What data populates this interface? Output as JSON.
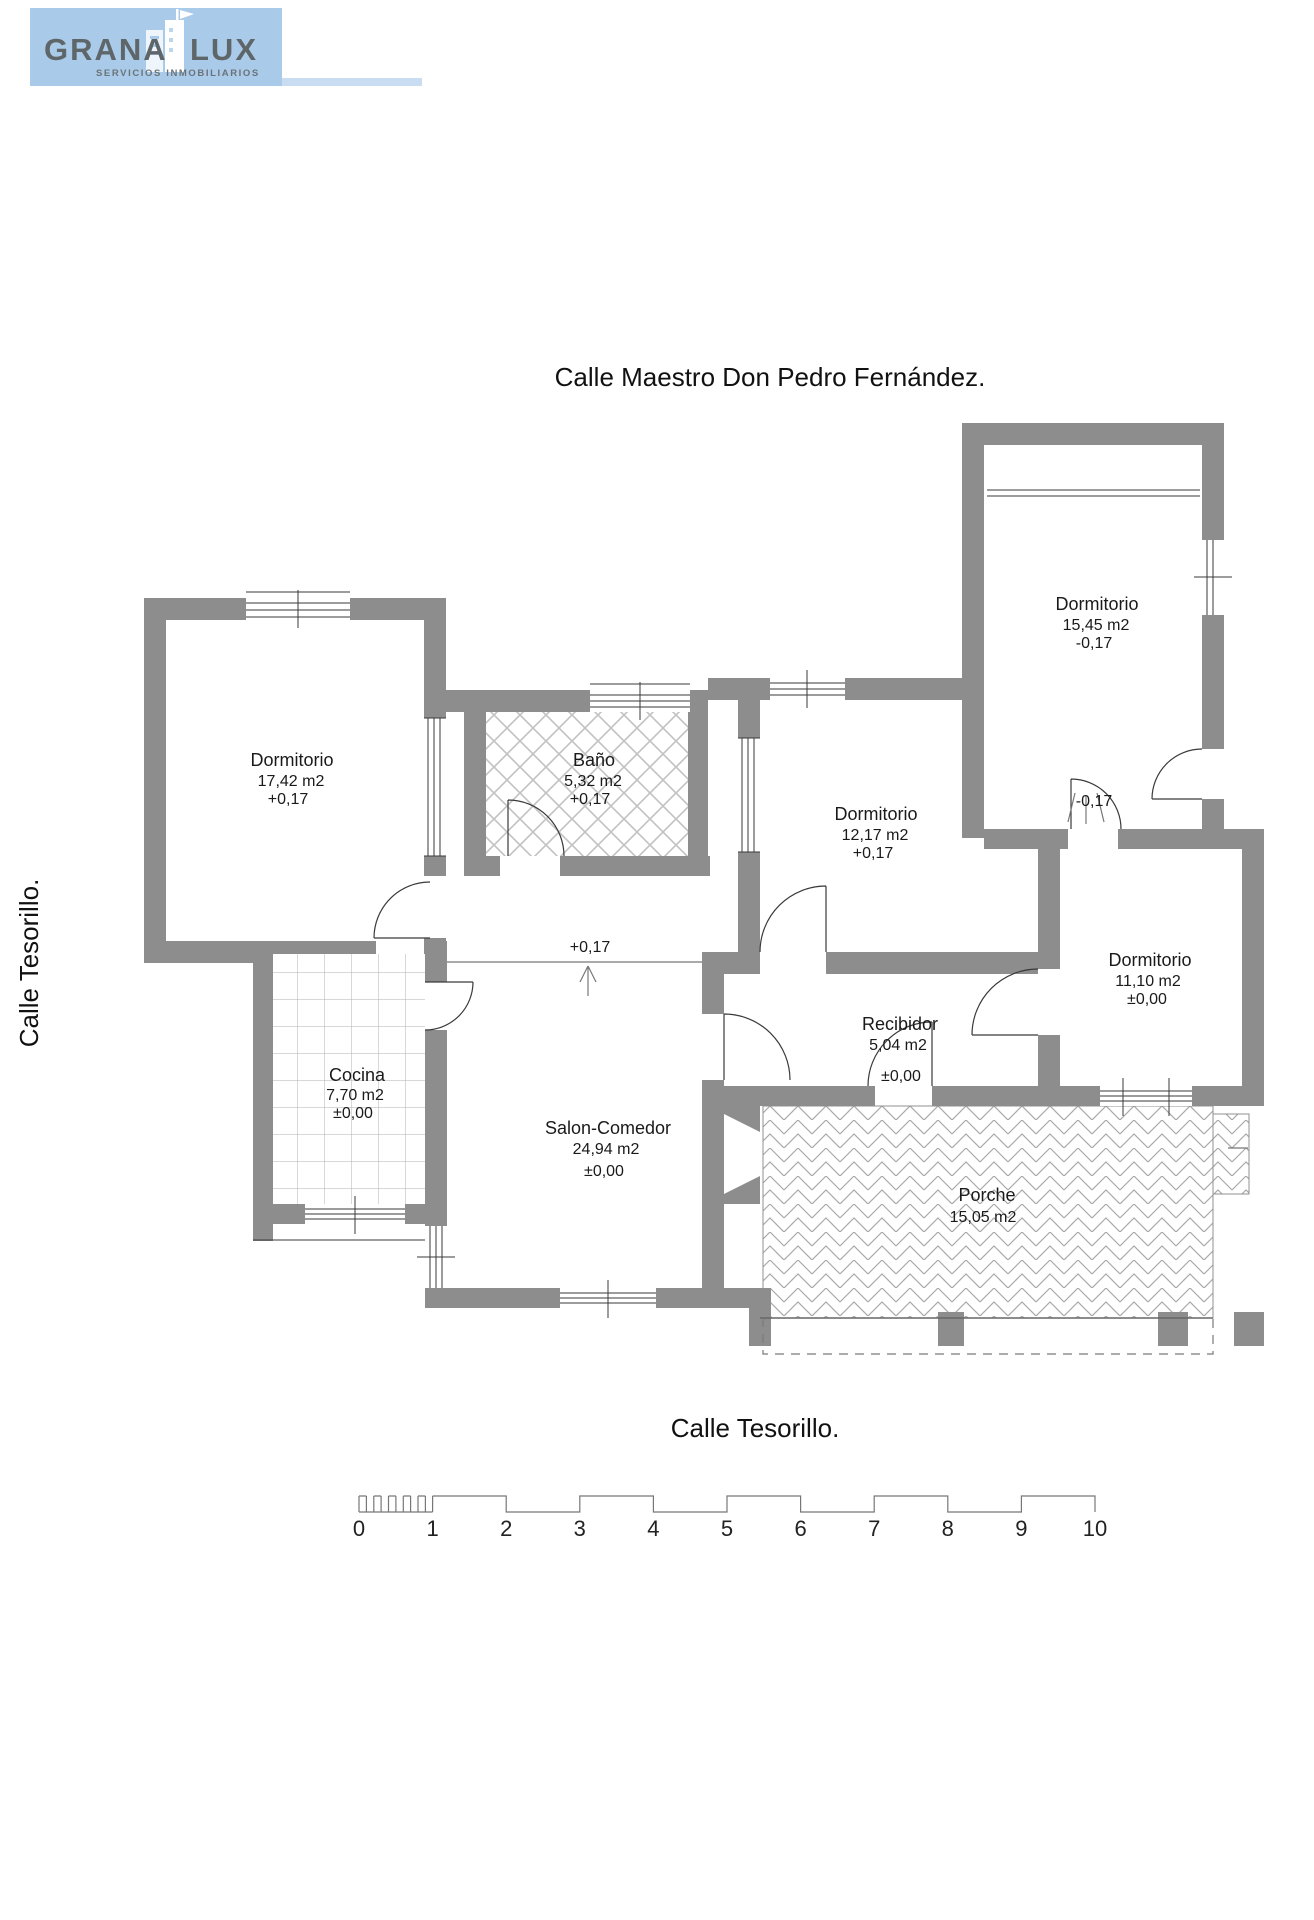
{
  "logo": {
    "brand_left": "GRANA",
    "brand_right": "LUX",
    "tagline": "SERVICIOS INMOBILIARIOS"
  },
  "streets": {
    "top": "Calle  Maestro Don Pedro Fernández.",
    "left": "Calle  Tesorillo.",
    "bottom": "Calle  Tesorillo."
  },
  "rooms": {
    "dormitorio_1742": {
      "name": "Dormitorio",
      "area": "17,42 m2",
      "level": "+0,17"
    },
    "bano": {
      "name": "Baño",
      "area": "5,32 m2",
      "level": "+0,17"
    },
    "dormitorio_1217": {
      "name": "Dormitorio",
      "area": "12,17 m2",
      "level": "+0,17"
    },
    "dormitorio_1545": {
      "name": "Dormitorio",
      "area": "15,45 m2",
      "level": "-0,17"
    },
    "dormitorio_1110": {
      "name": "Dormitorio",
      "area": "11,10 m2",
      "level": "±0,00"
    },
    "cocina": {
      "name": "Cocina",
      "area": "7,70 m2",
      "level": "±0,00"
    },
    "salon": {
      "name": "Salon-Comedor",
      "area": "24,94 m2",
      "level": "±0,00"
    },
    "recibidor": {
      "name": "Recibidor",
      "area": "5,04 m2",
      "level": "±0,00"
    },
    "porche": {
      "name": "Porche",
      "area": "15,05 m2"
    }
  },
  "annotations": {
    "hall_level": "+0,17",
    "step_level": "-0,17"
  },
  "scale_bar": {
    "ticks": [
      "0",
      "1",
      "2",
      "3",
      "4",
      "5",
      "6",
      "7",
      "8",
      "9",
      "10"
    ]
  },
  "colors": {
    "wall": "#8d8d8d",
    "logo_bg": "#a9cbe9",
    "logo_text": "#5f666a"
  }
}
